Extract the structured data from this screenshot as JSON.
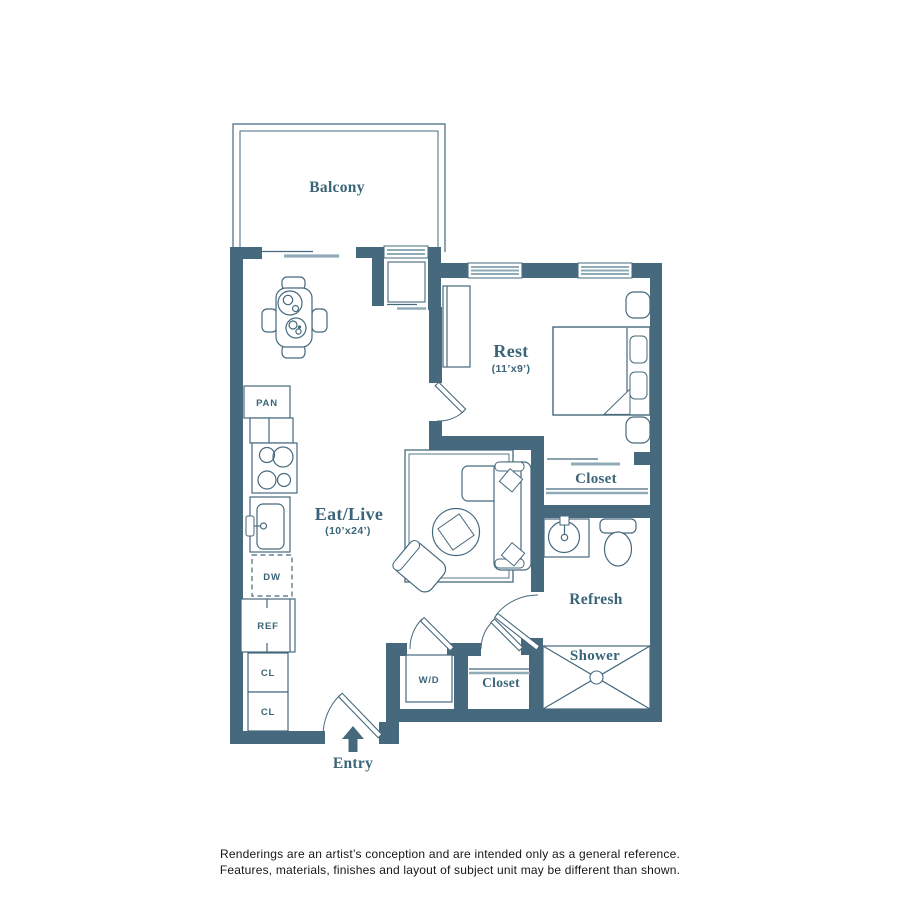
{
  "colors": {
    "wall": "#46697d",
    "fixture_line": "#46697d",
    "light_line": "#8fabb8",
    "label_text": "#3a6477",
    "disclaimer_text": "#161616",
    "background": "#ffffff"
  },
  "rooms": {
    "balcony": {
      "label": "Balcony"
    },
    "rest": {
      "label": "Rest",
      "dims": "(11’x9’)"
    },
    "eat_live": {
      "label": "Eat/Live",
      "dims": "(10’x24’)"
    },
    "bedroom_closet": {
      "label": "Closet"
    },
    "refresh": {
      "label": "Refresh"
    },
    "shower": {
      "label": "Shower"
    },
    "hall_closet": {
      "label": "Closet"
    },
    "entry": {
      "label": "Entry"
    }
  },
  "fixtures": {
    "pantry": "PAN",
    "dishwasher": "DW",
    "refrigerator": "REF",
    "closet_upper": "CL",
    "closet_lower": "CL",
    "washer_dryer": "W/D"
  },
  "icons": {
    "entry_arrow": "up-arrow"
  },
  "disclaimer": {
    "line1": "Renderings are an artist’s conception and are intended only as a general reference.",
    "line2": "Features, materials, finishes and layout of subject unit may be different than shown."
  }
}
